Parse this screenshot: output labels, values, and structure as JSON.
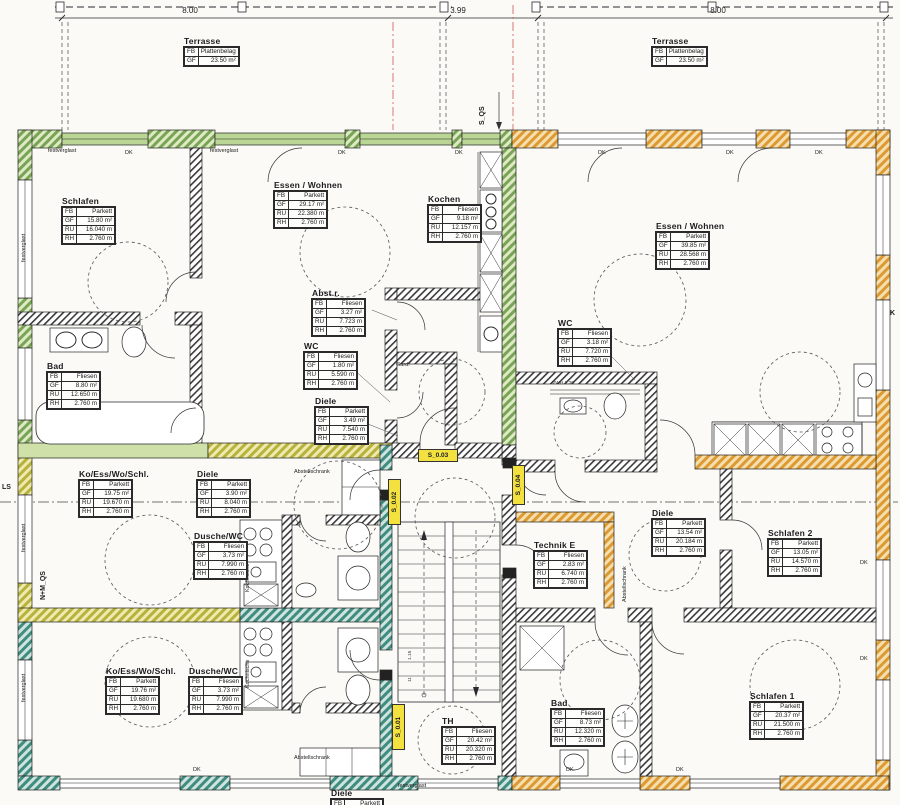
{
  "title": "Grundriss Wohnungen (floor plan)",
  "dimensions": {
    "left": "8.00",
    "mid": "3.99",
    "right": "8.00"
  },
  "labels": {
    "dk": "DK",
    "festverglast": "festverglast",
    "abstellschrank": "Abstellschrank",
    "kochnische": "Kochnische",
    "gard": "Gard.",
    "vwh": "VWH 1.30",
    "ls": "LS",
    "k": "K",
    "s_qs": "S_QS",
    "nm_qs": "N+M_QS",
    "s001": "S_0.01",
    "s002": "S_0.02",
    "s003": "S_0.03",
    "s004": "S_0.04",
    "stair_a": "1.15",
    "stair_b": "11"
  },
  "colors": {
    "wall_green": "#79a457",
    "wall_teal": "#3f8c80",
    "wall_orange": "#dd9a33",
    "highlight_yellow": "#f2e13e",
    "section_line_red": "#d46a6a"
  },
  "rooms": [
    {
      "name": "Terrasse",
      "rows": [
        {
          "k": "FB",
          "v": "Plattenbelag"
        },
        {
          "k": "GF",
          "v": "23.50 m²"
        }
      ]
    },
    {
      "name": "Terrasse",
      "rows": [
        {
          "k": "FB",
          "v": "Plattenbelag"
        },
        {
          "k": "GF",
          "v": "23.50 m²"
        }
      ]
    },
    {
      "name": "Schlafen",
      "rows": [
        {
          "k": "FB",
          "v": "Parkett"
        },
        {
          "k": "GF",
          "v": "15.80 m²"
        },
        {
          "k": "RU",
          "v": "16.040 m"
        },
        {
          "k": "RH",
          "v": "2.760 m"
        }
      ]
    },
    {
      "name": "Essen / Wohnen",
      "rows": [
        {
          "k": "FB",
          "v": "Parkett"
        },
        {
          "k": "GF",
          "v": "29.17 m²"
        },
        {
          "k": "RU",
          "v": "22.380 m"
        },
        {
          "k": "RH",
          "v": "2.760 m"
        }
      ]
    },
    {
      "name": "Kochen",
      "rows": [
        {
          "k": "FB",
          "v": "Fliesen"
        },
        {
          "k": "GF",
          "v": "9.18 m²"
        },
        {
          "k": "RU",
          "v": "12.157 m"
        },
        {
          "k": "RH",
          "v": "2.760 m"
        }
      ]
    },
    {
      "name": "Abst.r.",
      "rows": [
        {
          "k": "FB",
          "v": "Fliesen"
        },
        {
          "k": "GF",
          "v": "3.27 m²"
        },
        {
          "k": "RU",
          "v": "7.723 m"
        },
        {
          "k": "RH",
          "v": "2.760 m"
        }
      ]
    },
    {
      "name": "WC",
      "rows": [
        {
          "k": "FB",
          "v": "Fliesen"
        },
        {
          "k": "GF",
          "v": "1.80 m²"
        },
        {
          "k": "RU",
          "v": "5.590 m"
        },
        {
          "k": "RH",
          "v": "2.760 m"
        }
      ]
    },
    {
      "name": "Diele",
      "rows": [
        {
          "k": "FB",
          "v": "Parkett"
        },
        {
          "k": "GF",
          "v": "3.49 m²"
        },
        {
          "k": "RU",
          "v": "7.540 m"
        },
        {
          "k": "RH",
          "v": "2.760 m"
        }
      ]
    },
    {
      "name": "Bad",
      "rows": [
        {
          "k": "FB",
          "v": "Fliesen"
        },
        {
          "k": "GF",
          "v": "8.80 m²"
        },
        {
          "k": "RU",
          "v": "12.650 m"
        },
        {
          "k": "RH",
          "v": "2.760 m"
        }
      ]
    },
    {
      "name": "Essen / Wohnen",
      "rows": [
        {
          "k": "FB",
          "v": "Parkett"
        },
        {
          "k": "GF",
          "v": "39.85 m²"
        },
        {
          "k": "RU",
          "v": "28.568 m"
        },
        {
          "k": "RH",
          "v": "2.760 m"
        }
      ]
    },
    {
      "name": "WC",
      "rows": [
        {
          "k": "FB",
          "v": "Fliesen"
        },
        {
          "k": "GF",
          "v": "3.18 m²"
        },
        {
          "k": "RU",
          "v": "7.720 m"
        },
        {
          "k": "RH",
          "v": "2.760 m"
        }
      ]
    },
    {
      "name": "Ko/Ess/Wo/Schl.",
      "rows": [
        {
          "k": "FB",
          "v": "Parkett"
        },
        {
          "k": "GF",
          "v": "19.75 m²"
        },
        {
          "k": "RU",
          "v": "19.670 m"
        },
        {
          "k": "RH",
          "v": "2.760 m"
        }
      ]
    },
    {
      "name": "Diele",
      "rows": [
        {
          "k": "FB",
          "v": "Parkett"
        },
        {
          "k": "GF",
          "v": "3.90 m²"
        },
        {
          "k": "RU",
          "v": "8.040 m"
        },
        {
          "k": "RH",
          "v": "2.760 m"
        }
      ]
    },
    {
      "name": "Dusche/WC",
      "rows": [
        {
          "k": "FB",
          "v": "Fliesen"
        },
        {
          "k": "GF",
          "v": "3.73 m²"
        },
        {
          "k": "RU",
          "v": "7.990 m"
        },
        {
          "k": "RH",
          "v": "2.760 m"
        }
      ]
    },
    {
      "name": "Ko/Ess/Wo/Schl.",
      "rows": [
        {
          "k": "FB",
          "v": "Parkett"
        },
        {
          "k": "GF",
          "v": "19.76 m²"
        },
        {
          "k": "RU",
          "v": "19.680 m"
        },
        {
          "k": "RH",
          "v": "2.760 m"
        }
      ]
    },
    {
      "name": "Dusche/WC",
      "rows": [
        {
          "k": "FB",
          "v": "Fliesen"
        },
        {
          "k": "GF",
          "v": "3.73 m²"
        },
        {
          "k": "RU",
          "v": "7.990 m"
        },
        {
          "k": "RH",
          "v": "2.760 m"
        }
      ]
    },
    {
      "name": "Technik E",
      "rows": [
        {
          "k": "FB",
          "v": "Fliesen"
        },
        {
          "k": "GF",
          "v": "2.83 m²"
        },
        {
          "k": "RU",
          "v": "6.740 m"
        },
        {
          "k": "RH",
          "v": "2.760 m"
        }
      ]
    },
    {
      "name": "Diele",
      "rows": [
        {
          "k": "FB",
          "v": "Parkett"
        },
        {
          "k": "GF",
          "v": "13.54 m²"
        },
        {
          "k": "RU",
          "v": "20.184 m"
        },
        {
          "k": "RH",
          "v": "2.760 m"
        }
      ]
    },
    {
      "name": "Schlafen 2",
      "rows": [
        {
          "k": "FB",
          "v": "Parkett"
        },
        {
          "k": "GF",
          "v": "13.05 m²"
        },
        {
          "k": "RU",
          "v": "14.570 m"
        },
        {
          "k": "RH",
          "v": "2.760 m"
        }
      ]
    },
    {
      "name": "Bad",
      "rows": [
        {
          "k": "FB",
          "v": "Fliesen"
        },
        {
          "k": "GF",
          "v": "8.73 m²"
        },
        {
          "k": "RU",
          "v": "12.320 m"
        },
        {
          "k": "RH",
          "v": "2.760 m"
        }
      ]
    },
    {
      "name": "Schlafen 1",
      "rows": [
        {
          "k": "FB",
          "v": "Parkett"
        },
        {
          "k": "GF",
          "v": "20.37 m²"
        },
        {
          "k": "RU",
          "v": "21.500 m"
        },
        {
          "k": "RH",
          "v": "2.760 m"
        }
      ]
    },
    {
      "name": "TH",
      "rows": [
        {
          "k": "FB",
          "v": "Fliesen"
        },
        {
          "k": "GF",
          "v": "20.42 m²"
        },
        {
          "k": "RU",
          "v": "20.320 m"
        },
        {
          "k": "RH",
          "v": "2.760 m"
        }
      ]
    },
    {
      "name": "Diele",
      "rows": [
        {
          "k": "FB",
          "v": "Parkett"
        }
      ]
    }
  ]
}
